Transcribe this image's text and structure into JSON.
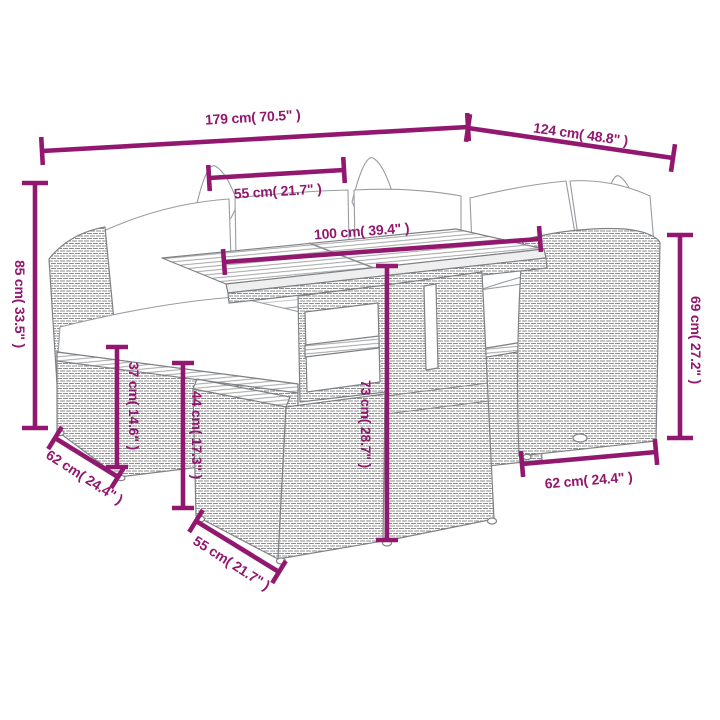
{
  "figure": {
    "kind": "product-dimension-diagram",
    "subject": "poly rattan garden lounge set with slatted-top table and ottomans",
    "background": "#ffffff"
  },
  "colors": {
    "dimension": "#92186F",
    "line_art": "#7e8286",
    "texture": "#8d8d8d"
  },
  "dimension_lines": [
    {
      "id": "total-width",
      "label": "179 cm( 70.5\" )",
      "value_cm": 179,
      "value_in": 70.5,
      "x1": 42,
      "y1": 151,
      "x2": 468,
      "y2": 127,
      "tick": 28,
      "label_x": 253,
      "label_y": 122,
      "label_rot": -3.2
    },
    {
      "id": "total-depth",
      "label": "124 cm( 48.8\" )",
      "value_cm": 124,
      "value_in": 48.8,
      "x1": 468,
      "y1": 128,
      "x2": 673,
      "y2": 158,
      "tick": 28,
      "label_x": 580,
      "label_y": 139,
      "label_rot": 8
    },
    {
      "id": "back-cushion-width",
      "label": "55 cm( 21.7\" )",
      "value_cm": 55,
      "value_in": 21.7,
      "x1": 209,
      "y1": 178,
      "x2": 344,
      "y2": 170,
      "tick": 26,
      "label_x": 278,
      "label_y": 196,
      "label_rot": -3.4
    },
    {
      "id": "tabletop-length",
      "label": "100 cm( 39.4\" )",
      "value_cm": 100,
      "value_in": 39.4,
      "x1": 224,
      "y1": 262,
      "x2": 540,
      "y2": 239,
      "tick": 26,
      "label_x": 362,
      "label_y": 236,
      "label_rot": -4.2
    },
    {
      "id": "sofa-height",
      "label": "85 cm( 33.5\" )",
      "value_cm": 85,
      "value_in": 33.5,
      "x1": 35,
      "y1": 183,
      "x2": 35,
      "y2": 428,
      "tick": 26,
      "label_x": 15,
      "label_y": 304,
      "label_rot": 90
    },
    {
      "id": "armrest-height",
      "label": "69 cm( 27.2\" )",
      "value_cm": 69,
      "value_in": 27.2,
      "x1": 680,
      "y1": 235,
      "x2": 680,
      "y2": 438,
      "tick": 26,
      "label_x": 691,
      "label_y": 340,
      "label_rot": 90
    },
    {
      "id": "base-height",
      "label": "37 cm( 14.6\" )",
      "value_cm": 37,
      "value_in": 14.6,
      "x1": 117,
      "y1": 347,
      "x2": 117,
      "y2": 467,
      "tick": 22,
      "label_x": 129,
      "label_y": 406,
      "label_rot": 90
    },
    {
      "id": "ottoman-height",
      "label": "44 cm( 17.3\" )",
      "value_cm": 44,
      "value_in": 17.3,
      "x1": 183,
      "y1": 363,
      "x2": 183,
      "y2": 508,
      "tick": 22,
      "label_x": 192,
      "label_y": 435,
      "label_rot": 90
    },
    {
      "id": "table-height",
      "label": "73 cm( 28.7\" )",
      "value_cm": 73,
      "value_in": 28.7,
      "x1": 387,
      "y1": 266,
      "x2": 387,
      "y2": 540,
      "tick": 22,
      "label_x": 361,
      "label_y": 424,
      "label_rot": 90
    },
    {
      "id": "sofa-depth-left",
      "label": "62 cm( 24.4\" )",
      "value_cm": 62,
      "value_in": 24.4,
      "x1": 55,
      "y1": 438,
      "x2": 118,
      "y2": 477,
      "tick": 26,
      "label_x": 82,
      "label_y": 481,
      "label_rot": 32.5
    },
    {
      "id": "ottoman-width",
      "label": "55 cm( 21.7\" )",
      "value_cm": 55,
      "value_in": 21.7,
      "x1": 196,
      "y1": 521,
      "x2": 279,
      "y2": 572,
      "tick": 26,
      "label_x": 229,
      "label_y": 567,
      "label_rot": 32.5
    },
    {
      "id": "sofa-depth-right",
      "label": "62 cm( 24.4\" )",
      "value_cm": 62,
      "value_in": 24.4,
      "x1": 522,
      "y1": 464,
      "x2": 656,
      "y2": 452,
      "tick": 26,
      "label_x": 589,
      "label_y": 485,
      "label_rot": -4.5
    }
  ]
}
